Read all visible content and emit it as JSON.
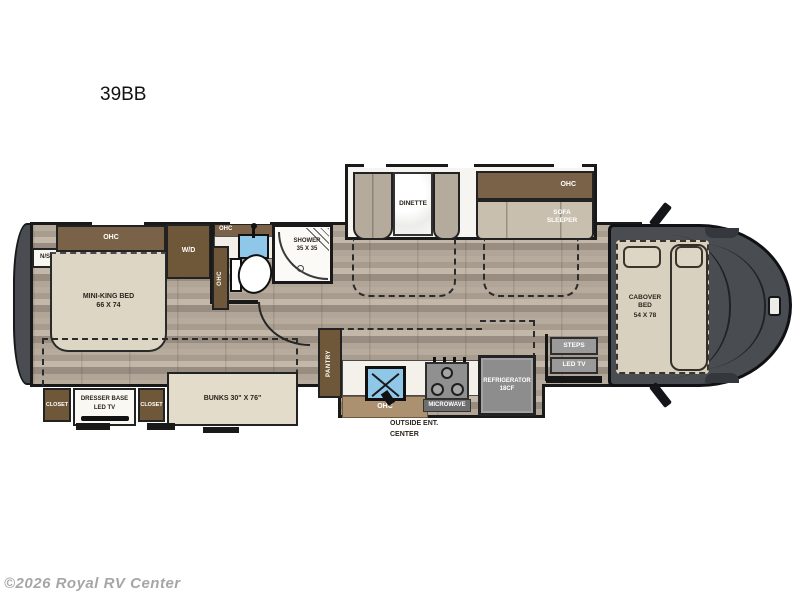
{
  "title": "39BB",
  "watermark": "©2026 Royal RV Center",
  "colors": {
    "cabinet_brown": "#6f5839",
    "ohc_brown": "#7a6249",
    "bed_beige": "#ded6c4",
    "bench_tan": "#b5ab9d",
    "sofa_tan": "#c8bfae",
    "appliance_gray": "#8d8d8d",
    "cab_gray": "#494d52",
    "sink_blue": "#8ec7e8",
    "floor_taupe": "#aba092"
  },
  "bedroom": {
    "nightstand": "N/S",
    "ohc": "OHC",
    "bed_line1": "MINI-KING BED",
    "bed_line2": "66 X 74",
    "washer_dryer": "W/D"
  },
  "bathroom": {
    "ohc_top": "OHC",
    "ohc_side": "OHC",
    "shower_line1": "SHOWER",
    "shower_line2": "35 X 35"
  },
  "hall": {
    "pantry": "PANTRY"
  },
  "kitchen": {
    "ohc": "OHC",
    "microwave": "MICROWAVE",
    "refrigerator_line1": "REFRIGERATOR",
    "refrigerator_line2": "18CF",
    "outside_line1": "OUTSIDE ENT.",
    "outside_line2": "CENTER"
  },
  "entry": {
    "steps": "STEPS",
    "led_tv": "LED TV"
  },
  "slide_out": {
    "dinette": "DINETTE",
    "ohc": "OHC",
    "sofa_line1": "SOFA",
    "sofa_line2": "SLEEPER"
  },
  "cab": {
    "bed_line1": "CABOVER",
    "bed_line2": "BED",
    "bed_line3": "54 X 78"
  },
  "garage": {
    "closet_left": "CLOSET",
    "dresser_line1": "DRESSER BASE",
    "dresser_line2": "LED TV",
    "closet_right": "CLOSET",
    "bunks": "BUNKS 30\" X 76\""
  }
}
